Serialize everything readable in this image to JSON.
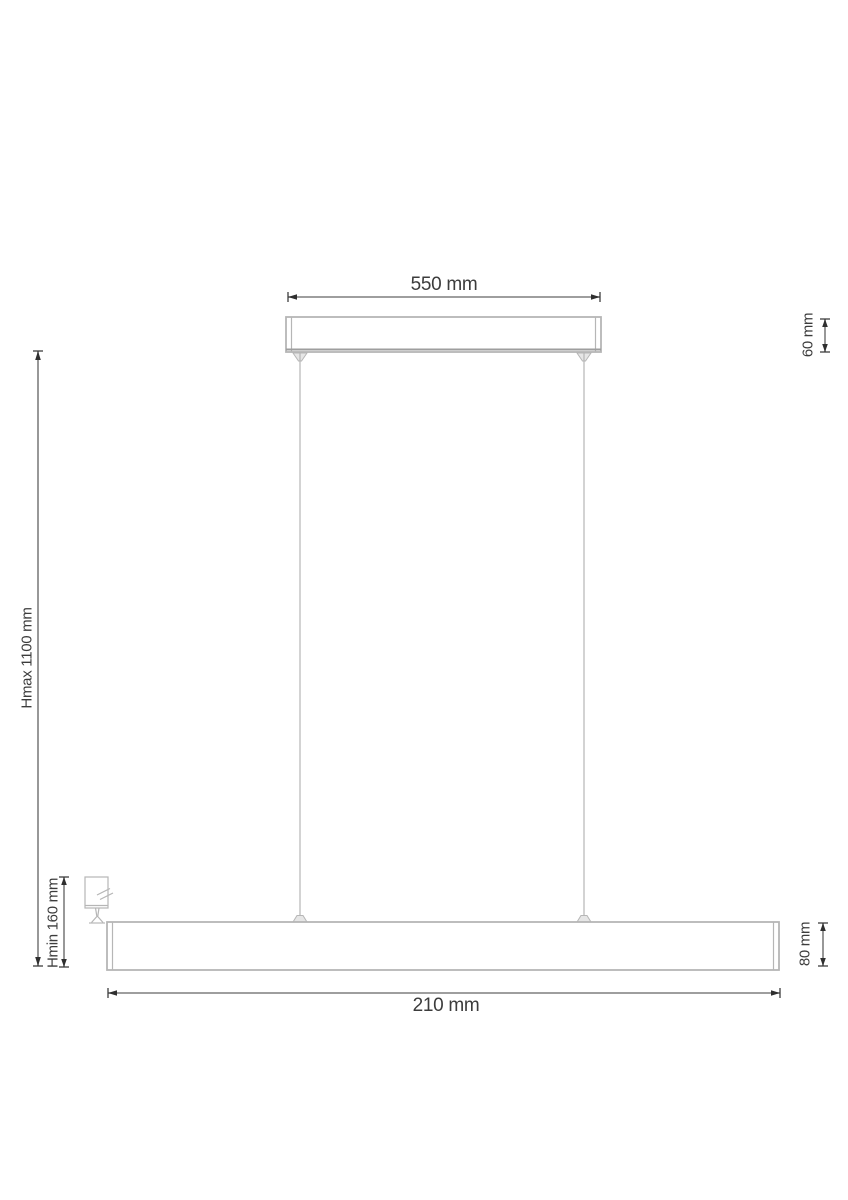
{
  "diagram": {
    "kind": "pendant-lamp-dimension-drawing",
    "unit": "mm",
    "labels": {
      "canopy_width": "550 mm",
      "canopy_height": "60 mm",
      "max_height": "Hmax 1100 mm",
      "min_height": "Hmin 160 mm",
      "bar_height": "80 mm",
      "bar_length": "210 mm"
    },
    "colors": {
      "background": "#ffffff",
      "fixture_line": "#b6b6b6",
      "fixture_edge": "#9e9e9e",
      "dimension_line": "#7f7f7f",
      "arrow": "#2f2f2f",
      "text": "#3c3c3c"
    }
  }
}
